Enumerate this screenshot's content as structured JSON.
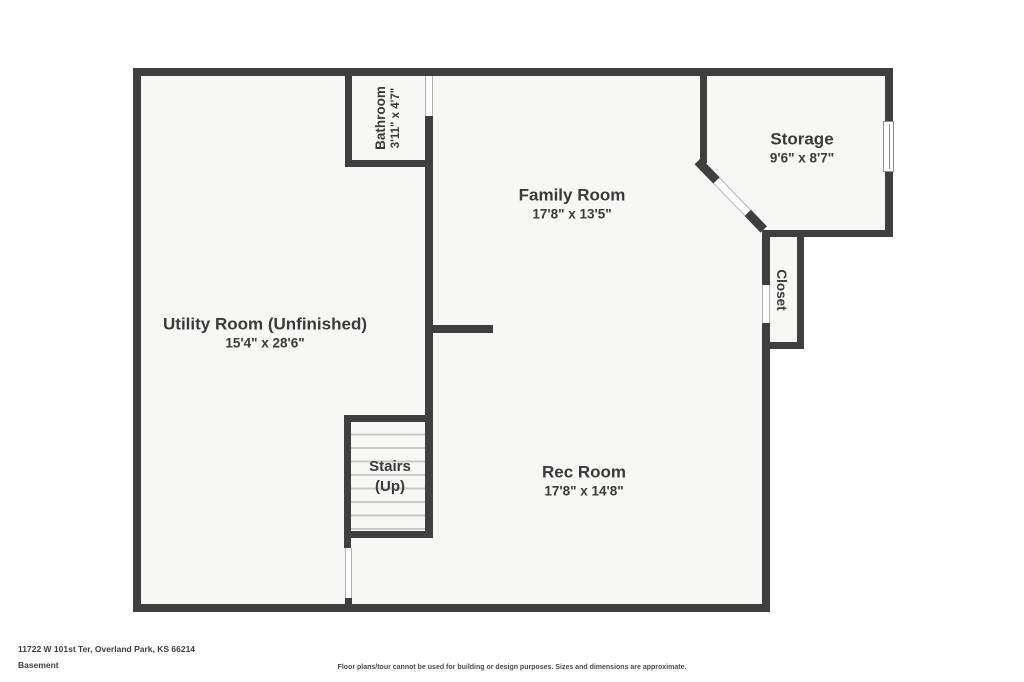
{
  "plan": {
    "rooms": {
      "bathroom": {
        "name": "Bathroom",
        "dims": "3'11\" x 4'7\""
      },
      "family": {
        "name": "Family Room",
        "dims": "17'8\" x 13'5\""
      },
      "storage": {
        "name": "Storage",
        "dims": "9'6\" x 8'7\""
      },
      "closet": {
        "name": "Closet"
      },
      "utility": {
        "name": "Utility Room (Unfinished)",
        "dims": "15'4\" x 28'6\""
      },
      "stairs": {
        "line1": "Stairs",
        "line2": "(Up)"
      },
      "rec": {
        "name": "Rec Room",
        "dims": "17'8\" x 14'8\""
      }
    },
    "colors": {
      "wall": "#3f3f3f",
      "room_fill": "#f7f7f6",
      "stair_tread": "#c9c9c9",
      "label_text": "#3a3a3a",
      "outside": "#ffffff"
    }
  },
  "footer": {
    "address": "11722 W 101st Ter, Overland Park, KS 66214",
    "floor": "Basement",
    "disclaimer": "Floor plans/tour cannot be used for building or design purposes. Sizes and dimensions are approximate."
  }
}
